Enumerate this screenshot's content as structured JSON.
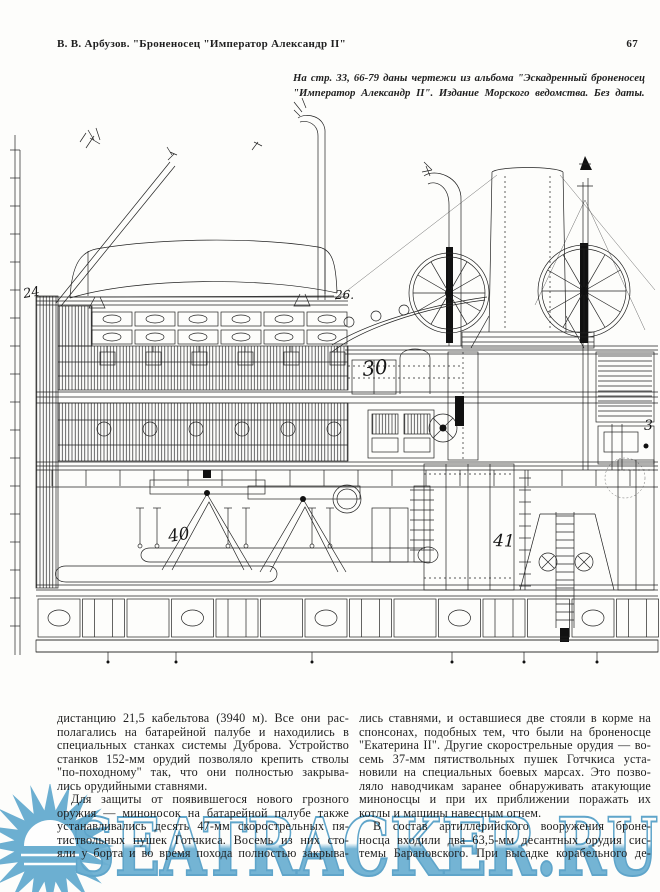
{
  "header": {
    "title": "В. В. Арбузов. \"Броненосец \"Император Александр II\"",
    "page_number": "67"
  },
  "caption": {
    "line1": "На стр. 33, 66-79 даны чертежи из альбома \"Эскадренный броненосец",
    "line2": "\"Император Александр II\". Издание Морского ведомства. Без даты."
  },
  "figure": {
    "labels": [
      {
        "t": "24",
        "x": 24,
        "y": 298,
        "s": 13,
        "r": -10
      },
      {
        "t": "26.",
        "x": 335,
        "y": 299,
        "s": 12,
        "r": 0
      },
      {
        "t": "30",
        "x": 363,
        "y": 376,
        "s": 20,
        "r": -6
      },
      {
        "t": "40",
        "x": 169,
        "y": 542,
        "s": 17,
        "r": -9
      },
      {
        "t": "41",
        "x": 493,
        "y": 546,
        "s": 17,
        "r": 2
      },
      {
        "t": "3",
        "x": 644,
        "y": 430,
        "s": 14,
        "r": 0
      }
    ]
  },
  "body": {
    "left": [
      {
        "t": "дистанцию 21,5 кабельтова (3940 м). Все они рас-",
        "c": "jl"
      },
      {
        "t": "полагались на батарейной палубе и находились в",
        "c": "jl"
      },
      {
        "t": "специальных станках системы Дуброва. Устройство",
        "c": "jl"
      },
      {
        "t": "станков 152-мм орудий позволяло крепить стволы",
        "c": "jl"
      },
      {
        "t": "\"по-походному\" так, что они полностью закрыва-",
        "c": "jl"
      },
      {
        "t": "лись орудийными ставнями.",
        "c": "sl"
      },
      {
        "t": "Для защиты от появившегося нового грозного",
        "c": "jl in"
      },
      {
        "t": "оружия — миноносок на батарейной палубе также",
        "c": "jl"
      },
      {
        "t": "устанавливались десять 47-мм скорострельных пя-",
        "c": "jl"
      },
      {
        "t": "тиствольных пушек Готчкиса. Восемь из них сто-",
        "c": "jl"
      },
      {
        "t": "яли у борта и во время похода полностью закрыва-",
        "c": "jl"
      }
    ],
    "right": [
      {
        "t": "лись ставнями, и оставшиеся две стояли в корме на",
        "c": "jl"
      },
      {
        "t": "спонсонах, подобных тем, что были на броненосце",
        "c": "jl"
      },
      {
        "t": "\"Екатерина II\". Другие скорострельные орудия — во-",
        "c": "jl"
      },
      {
        "t": "семь 37-мм пятиствольных пушек Готчкиса уста-",
        "c": "jl"
      },
      {
        "t": "новили на специальных боевых марсах. Это позво-",
        "c": "jl"
      },
      {
        "t": "ляло наводчикам заранее обнаруживать атакующие",
        "c": "jl"
      },
      {
        "t": "миноносцы и при их приближении поражать их",
        "c": "jl"
      },
      {
        "t": "котлы и машины навесным огнем.",
        "c": "sl"
      },
      {
        "t": "В состав артиллерийского вооружения броне-",
        "c": "jl in"
      },
      {
        "t": "носца входили два 63,5-мм десантных орудия сис-",
        "c": "jl"
      },
      {
        "t": "темы Барановского. При высадке корабельного де-",
        "c": "jl"
      }
    ]
  },
  "watermark": {
    "text": "SEATRACKER.RU",
    "color": "#4d9fc9",
    "outline_color": "#3d92c0"
  }
}
